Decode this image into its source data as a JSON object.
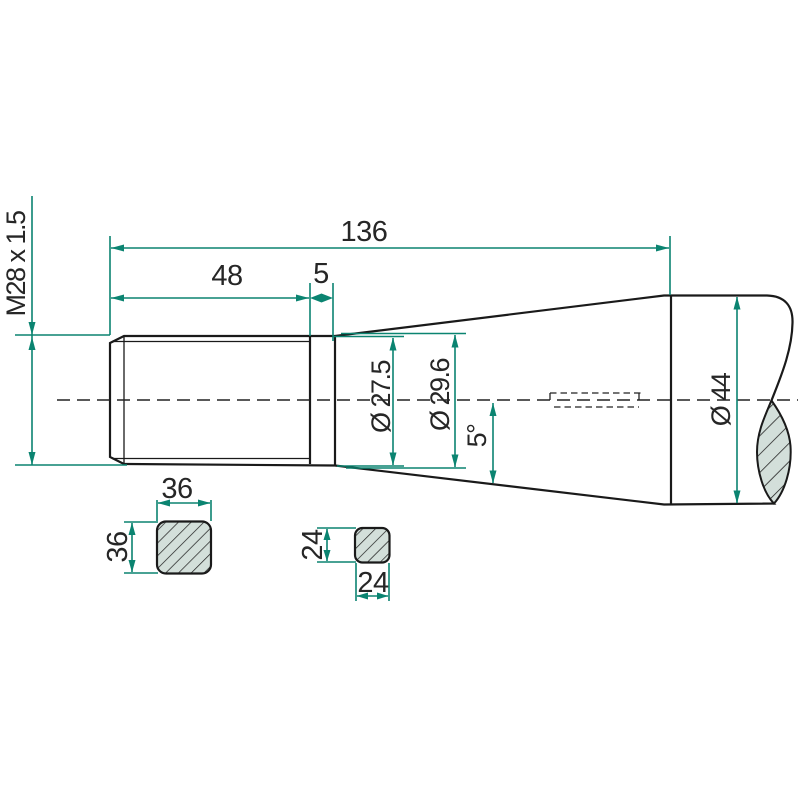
{
  "page": {
    "type": "technical-drawing",
    "background": "#ffffff"
  },
  "colors": {
    "body_fill": "#8FB2AB",
    "section_fill": "#D3DFDA",
    "outline": "#1A1A1A",
    "dimension": "#0B8471",
    "text": "#262626"
  },
  "labels": {
    "total_length": "136",
    "thread_length": "48",
    "collar_width": "5",
    "thread_spec": "M28 x 1.5",
    "diameter_taper_start": "Ø 27.5",
    "diameter_taper_mid": "Ø 29.6",
    "taper_angle": "5°",
    "diameter_shank": "Ø 44",
    "square_large_width": "36",
    "square_large_height": "36",
    "square_small_height": "24",
    "square_small_width": "24"
  }
}
